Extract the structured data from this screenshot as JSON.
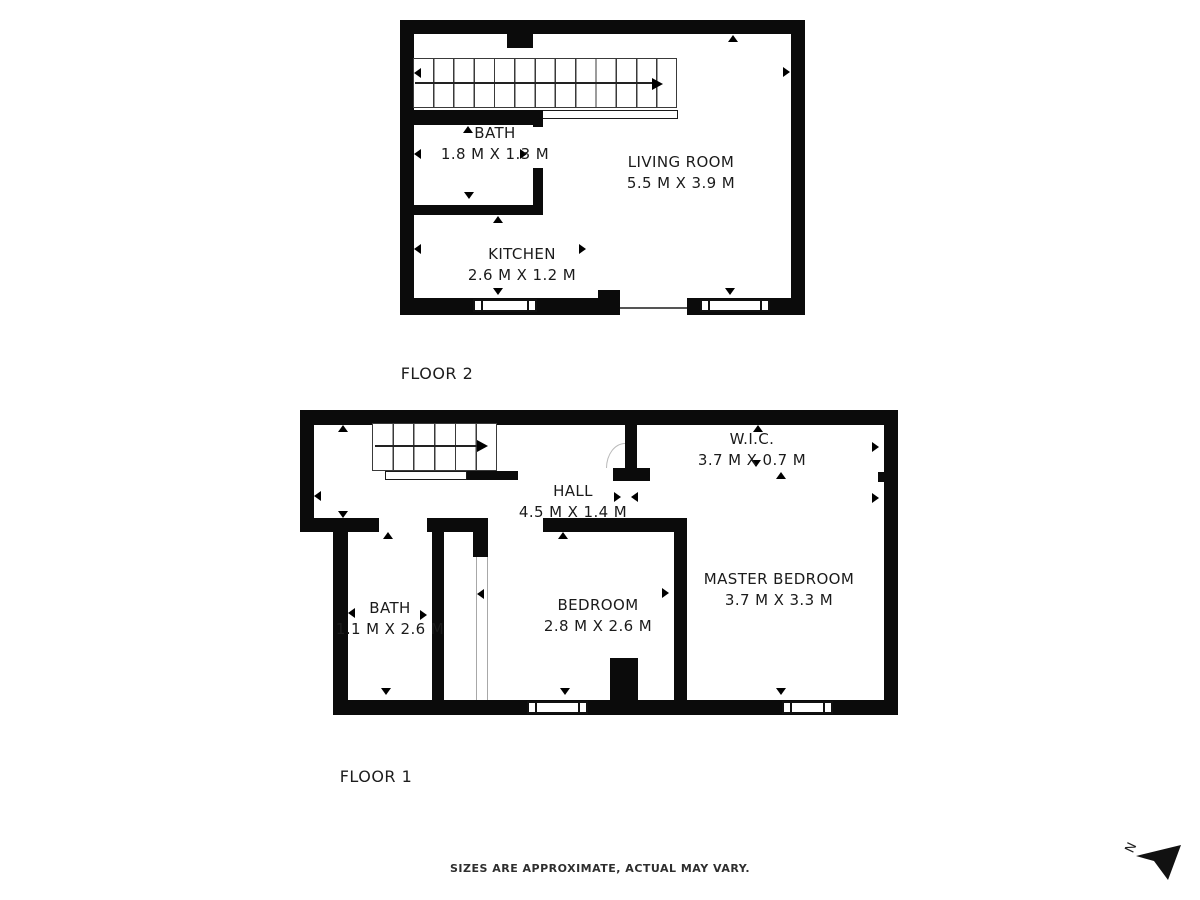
{
  "footer": {
    "text": "SIZES ARE APPROXIMATE, ACTUAL MAY VARY."
  },
  "compass": {
    "label": "N"
  },
  "colors": {
    "wall": "#0b0b0b",
    "background": "#ffffff",
    "text": "#1b1b1b",
    "stair_line": "#3a3a3a",
    "door_arc": "#b9b9b9"
  },
  "floor2": {
    "label": "FLOOR 2",
    "rooms": {
      "bath": {
        "name": "BATH",
        "dims": "1.8 M X 1.3 M"
      },
      "living_room": {
        "name": "LIVING ROOM",
        "dims": "5.5 M X 3.9 M"
      },
      "kitchen": {
        "name": "KITCHEN",
        "dims": "2.6 M X 1.2 M"
      }
    }
  },
  "floor1": {
    "label": "FLOOR 1",
    "rooms": {
      "hall": {
        "name": "HALL",
        "dims": "4.5 M X 1.4 M"
      },
      "wic": {
        "name": "W.I.C.",
        "dims": "3.7 M X 0.7 M"
      },
      "bath": {
        "name": "BATH",
        "dims": "1.1 M X 2.6 M"
      },
      "bedroom": {
        "name": "BEDROOM",
        "dims": "2.8 M X 2.6 M"
      },
      "master_bedroom": {
        "name": "MASTER BEDROOM",
        "dims": "3.7 M X 3.3 M"
      }
    }
  }
}
